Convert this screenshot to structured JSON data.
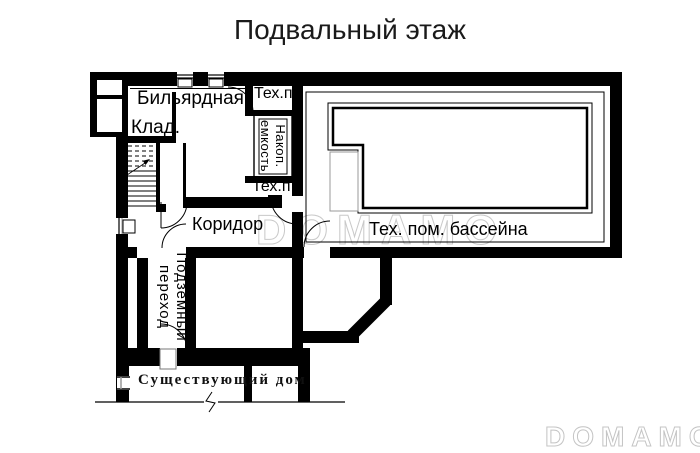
{
  "title": "Подвальный этаж",
  "labels": {
    "billiard_room": "Бильярдная",
    "storage": "Клад.",
    "tech_room_top": "Тех.п",
    "tank_line1": "Накоп.",
    "tank_line2": "емкость",
    "tech_room_bottom": "Тех.п",
    "corridor": "Коридор",
    "pool_tech_room": "Тех. пом. бассейна",
    "passage_line1": "Подземный",
    "passage_line2": "переход",
    "existing_house": "Существующий дом"
  },
  "watermarks": {
    "center": "DOMAMO",
    "bottom_right": "DOMAMO"
  },
  "colors": {
    "walls": "#000000",
    "watermark_outline": "#c9c9c9",
    "pool_step_gray": "#999999",
    "background": "#ffffff"
  }
}
